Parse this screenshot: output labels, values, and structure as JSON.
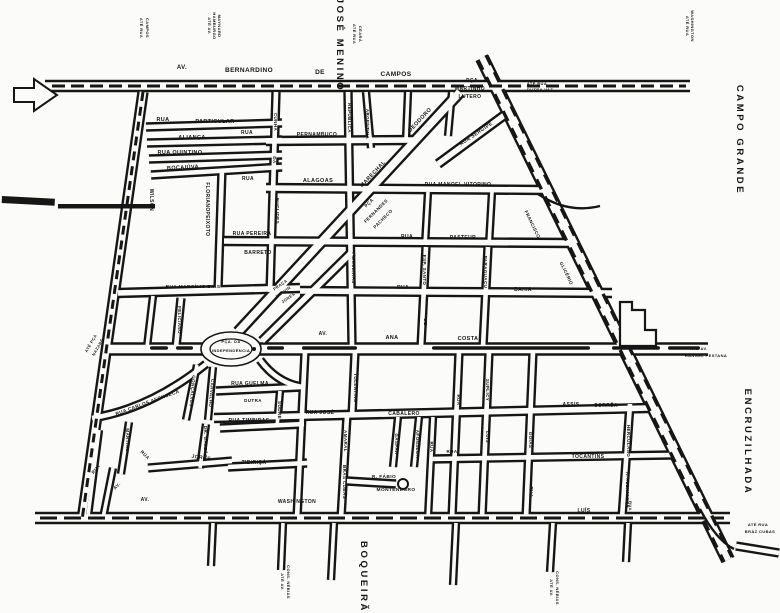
{
  "canvas": {
    "width": 780,
    "height": 613,
    "bg": "#fbfbf9",
    "ink": "#161616"
  },
  "districts": [
    {
      "text": "JOSÉ MENINO",
      "x": 337,
      "y": 45,
      "r": 90,
      "s": 9.5
    },
    {
      "text": "CAMPO GRANDE",
      "x": 737,
      "y": 140,
      "r": 90,
      "s": 9.5
    },
    {
      "text": "ENCRUZILHADA",
      "x": 745,
      "y": 442,
      "r": 90,
      "s": 9.5
    },
    {
      "text": "BOQUEIRÃO",
      "x": 361,
      "y": 582,
      "r": 90,
      "s": 9.5
    }
  ],
  "streets": [
    {
      "d": "M482,58 L728,560",
      "w": 12
    },
    {
      "d": "M45,86 L690,86",
      "w": 10
    },
    {
      "d": "M106,349 L708,349",
      "w": 11
    },
    {
      "d": "M35,518 L730,518",
      "w": 10
    },
    {
      "d": "M143,92 L82,520",
      "w": 9
    },
    {
      "d": "M238,332 L460,92",
      "w": 10
    },
    {
      "d": "M262,341 L352,252",
      "w": 8
    },
    {
      "d": "M438,164 L510,111",
      "w": 8
    },
    {
      "d": "M146,127 L282,123",
      "w": 7
    },
    {
      "d": "M147,143 L282,140",
      "w": 7
    },
    {
      "d": "M149,159 L282,155",
      "w": 7
    },
    {
      "d": "M151,175 L282,167",
      "w": 7
    },
    {
      "d": "M118,293 L300,288",
      "w": 8
    },
    {
      "d": "M266,141 L414,140",
      "w": 8
    },
    {
      "d": "M266,188 L545,190",
      "w": 8
    },
    {
      "d": "M224,241 L572,243",
      "w": 8
    },
    {
      "d": "M300,291 L612,293",
      "w": 8
    },
    {
      "d": "M276,92 L270,292",
      "w": 7
    },
    {
      "d": "M222,170 L218,290",
      "w": 7
    },
    {
      "d": "M348,92 L352,345",
      "w": 7
    },
    {
      "d": "M366,92 L371,148",
      "w": 6
    },
    {
      "d": "M408,92 L406,140",
      "w": 6
    },
    {
      "d": "M452,92 L448,136",
      "w": 6
    },
    {
      "d": "M428,192 L425,245",
      "w": 6
    },
    {
      "d": "M492,192 L489,245",
      "w": 6
    },
    {
      "d": "M426,247 L421,347",
      "w": 7
    },
    {
      "d": "M488,247 L483,347",
      "w": 7
    },
    {
      "d": "M181,298 L176,347",
      "w": 7
    },
    {
      "d": "M153,296 L147,347",
      "w": 6
    },
    {
      "d": "M92,418 Q150,409 206,364",
      "w": 7
    },
    {
      "d": "M197,365 L186,420",
      "w": 6
    },
    {
      "d": "M213,367 L208,420",
      "w": 6
    },
    {
      "d": "M148,468 L232,461",
      "w": 7
    },
    {
      "d": "M129,422 L121,474",
      "w": 6
    },
    {
      "d": "M206,424 L200,468",
      "w": 6
    },
    {
      "d": "M99,430 L88,516",
      "w": 6
    },
    {
      "d": "M113,468 L103,518",
      "w": 6
    },
    {
      "d": "M216,391 L302,387",
      "w": 7
    },
    {
      "d": "M260,360 Q277,383 302,387",
      "w": 7
    },
    {
      "d": "M220,428 L304,424",
      "w": 7
    },
    {
      "d": "M228,467 L307,463",
      "w": 7
    },
    {
      "d": "M280,391 L277,427",
      "w": 6
    },
    {
      "d": "M305,352 L297,518",
      "w": 7
    },
    {
      "d": "M355,352 L352,416",
      "w": 7
    },
    {
      "d": "M347,416 L341,518",
      "w": 7
    },
    {
      "d": "M214,418 L648,408",
      "w": 8
    },
    {
      "d": "M347,481 L396,484",
      "w": 7
    },
    {
      "d": "M398,417 L393,467",
      "w": 6
    },
    {
      "d": "M419,417 L414,467",
      "w": 6
    },
    {
      "d": "M433,417 L428,518",
      "w": 6
    },
    {
      "d": "M459,352 L452,518",
      "w": 7
    },
    {
      "d": "M489,352 L482,518",
      "w": 7
    },
    {
      "d": "M533,352 L526,518",
      "w": 7
    },
    {
      "d": "M430,459 L672,455",
      "w": 7
    },
    {
      "d": "M630,404 L622,518",
      "w": 7
    },
    {
      "d": "M213,523 L211,566",
      "w": 6
    },
    {
      "d": "M283,523 L281,570",
      "w": 6
    },
    {
      "d": "M334,523 L331,580",
      "w": 6
    },
    {
      "d": "M456,523 L453,585",
      "w": 6
    },
    {
      "d": "M553,523 L550,572",
      "w": 6
    },
    {
      "d": "M628,523 L626,562",
      "w": 6
    },
    {
      "d": "M736,546 L779,553",
      "w": 7
    }
  ],
  "overlays": [
    {
      "d": "M52,86 L686,86",
      "w": 3,
      "dash": "13 6"
    },
    {
      "d": "M40,518 L724,518",
      "w": 3,
      "dash": "17 7"
    },
    {
      "d": "M478,60 L724,562",
      "w": 3.4,
      "dash": "11 8"
    },
    {
      "d": "M486,55 L732,557",
      "w": 3.4,
      "dash": "11 8"
    },
    {
      "d": "M143,92 L82,520",
      "w": 3,
      "dash": "9 6"
    },
    {
      "d": "M538,194 Q568,214 600,206",
      "w": 2.4,
      "dash": ""
    },
    {
      "d": "M700,509 Q716,540 734,549",
      "w": 2.4,
      "dash": ""
    }
  ],
  "tram_pills_y": 346.3,
  "tram_pills": [
    [
      150,
      168
    ],
    [
      176,
      193
    ],
    [
      267,
      284
    ],
    [
      302,
      357
    ],
    [
      432,
      590
    ],
    [
      612,
      660
    ],
    [
      668,
      700
    ]
  ],
  "shapes": {
    "arrow_points": "14,88 34,88 34,79 57,95 34,111 34,102 14,102",
    "bars": [
      {
        "x": 2,
        "y": 196,
        "w": 53,
        "h": 7,
        "r": 3
      },
      {
        "x": 58,
        "y": 204,
        "w": 97,
        "h": 4.5,
        "r": 0
      }
    ],
    "building_d": "M620,302 L632,302 L632,310 L645,310 L645,330 L656,330 L656,346 L620,346 Z",
    "oval": {
      "cx": 231,
      "cy": 349,
      "rx": 30,
      "ry": 17
    },
    "oval_inner": {
      "cx": 231,
      "cy": 349,
      "rx": 21,
      "ry": 10
    },
    "dot": {
      "cx": 254,
      "cy": 349,
      "r": 2
    },
    "lollipop": {
      "cx": 403,
      "cy": 484,
      "r": 5
    }
  },
  "labels": [
    {
      "t": "AV.",
      "x": 182,
      "y": 69,
      "r": 0,
      "s": 6
    },
    {
      "t": "BERNARDINO",
      "x": 249,
      "y": 72,
      "r": 0,
      "s": 6.5
    },
    {
      "t": "DE",
      "x": 320,
      "y": 74,
      "r": 0,
      "s": 6.5
    },
    {
      "t": "CAMPOS",
      "x": 396,
      "y": 76,
      "r": 0,
      "s": 6.5
    },
    {
      "t": "PÇA",
      "x": 472,
      "y": 82,
      "r": 0,
      "s": 5
    },
    {
      "t": "MARTINHO",
      "x": 470,
      "y": 90,
      "r": 0,
      "s": 5
    },
    {
      "t": "LUTERO",
      "x": 470,
      "y": 98,
      "r": 0,
      "s": 5
    },
    {
      "t": "ATÉ RUA",
      "x": 537,
      "y": 85,
      "r": 0,
      "s": 4
    },
    {
      "t": "DUTRA VAZ",
      "x": 540,
      "y": 91,
      "r": 0,
      "s": 4
    },
    {
      "t": "ATÉ RUA",
      "x": 140,
      "y": 28,
      "r": 90,
      "s": 4
    },
    {
      "t": "CAMPOS",
      "x": 146,
      "y": 28,
      "r": 90,
      "s": 4
    },
    {
      "t": "ATÉ AV.",
      "x": 208,
      "y": 26,
      "r": 90,
      "s": 4
    },
    {
      "t": "HAMBURGO",
      "x": 213,
      "y": 26,
      "r": 90,
      "s": 4
    },
    {
      "t": "MAYNARD",
      "x": 218,
      "y": 26,
      "r": 90,
      "s": 4
    },
    {
      "t": "ATÉ RUA",
      "x": 353,
      "y": 34,
      "r": 90,
      "s": 4
    },
    {
      "t": "CEARÁ",
      "x": 359,
      "y": 34,
      "r": 90,
      "s": 4
    },
    {
      "t": "ATÉ RUA",
      "x": 686,
      "y": 26,
      "r": 90,
      "s": 4
    },
    {
      "t": "WASHINGTON",
      "x": 691,
      "y": 26,
      "r": 90,
      "s": 4
    },
    {
      "t": "RUA",
      "x": 163,
      "y": 121,
      "r": 0,
      "s": 5.5
    },
    {
      "t": "PARTICULAR",
      "x": 215,
      "y": 123,
      "r": 0,
      "s": 5.5
    },
    {
      "t": "ALIANÇA",
      "x": 192,
      "y": 139,
      "r": 0,
      "s": 5.5
    },
    {
      "t": "RUA QUINTINO",
      "x": 180,
      "y": 154,
      "r": 0,
      "s": 5.5
    },
    {
      "t": "BOCAIÚVA",
      "x": 183,
      "y": 169,
      "r": -3,
      "s": 5.5
    },
    {
      "t": "WILSON",
      "x": 150,
      "y": 200,
      "r": 90,
      "s": 5
    },
    {
      "t": "FLORIANO",
      "x": 206,
      "y": 197,
      "r": 90,
      "s": 5
    },
    {
      "t": "PEIXOTO",
      "x": 206,
      "y": 224,
      "r": 90,
      "s": 5
    },
    {
      "t": "RUA",
      "x": 247,
      "y": 134,
      "r": 0,
      "s": 5
    },
    {
      "t": "PERNAMBUCO",
      "x": 317,
      "y": 136,
      "r": 0,
      "s": 5
    },
    {
      "t": "CUNHA",
      "x": 274,
      "y": 122,
      "r": 90,
      "s": 4.5
    },
    {
      "t": "DA",
      "x": 273,
      "y": 160,
      "r": 90,
      "s": 4.5
    },
    {
      "t": "EUCLIDES",
      "x": 276,
      "y": 211,
      "r": 90,
      "s": 4.5
    },
    {
      "t": "RUA",
      "x": 248,
      "y": 180,
      "r": 0,
      "s": 5
    },
    {
      "t": "ALAGOAS",
      "x": 318,
      "y": 182,
      "r": 0,
      "s": 5.5
    },
    {
      "t": "REPÚBLICA",
      "x": 348,
      "y": 118,
      "r": 90,
      "s": 4.5
    },
    {
      "t": "ARGENTINA",
      "x": 366,
      "y": 124,
      "r": 90,
      "s": 4.5
    },
    {
      "t": "RUA PEREIRA",
      "x": 252,
      "y": 235,
      "r": 0,
      "s": 5
    },
    {
      "t": "BARRETO",
      "x": 258,
      "y": 254,
      "r": 0,
      "s": 5
    },
    {
      "t": "DEODORO",
      "x": 421,
      "y": 121,
      "r": -47,
      "s": 5.5
    },
    {
      "t": "MARECHAL",
      "x": 374,
      "y": 175,
      "r": -47,
      "s": 5.5
    },
    {
      "t": "RUA SERGIPE",
      "x": 477,
      "y": 135,
      "r": -34,
      "s": 5
    },
    {
      "t": "RUA MANOEL VITORINO",
      "x": 458,
      "y": 186,
      "r": 0,
      "s": 5
    },
    {
      "t": "PÇA",
      "x": 370,
      "y": 204,
      "r": -45,
      "s": 4.5
    },
    {
      "t": "FERNANDES",
      "x": 377,
      "y": 212,
      "r": -45,
      "s": 4.5
    },
    {
      "t": "PACHECO",
      "x": 384,
      "y": 220,
      "r": -45,
      "s": 4.5
    },
    {
      "t": "FILGUEIRAS",
      "x": 352,
      "y": 268,
      "r": 90,
      "s": 4.5
    },
    {
      "t": "RUA",
      "x": 407,
      "y": 238,
      "r": 0,
      "s": 5
    },
    {
      "t": "PASTEUR",
      "x": 463,
      "y": 239,
      "r": 0,
      "s": 5
    },
    {
      "t": "RUA",
      "x": 403,
      "y": 289,
      "r": 0,
      "s": 5
    },
    {
      "t": "BAHIA",
      "x": 523,
      "y": 291,
      "r": 0,
      "s": 5
    },
    {
      "t": "ESP. SANTO",
      "x": 423,
      "y": 270,
      "r": 90,
      "s": 4.5
    },
    {
      "t": "PARAGUAÇU",
      "x": 484,
      "y": 272,
      "r": 90,
      "s": 4.5
    },
    {
      "t": "FRANCISCO",
      "x": 531,
      "y": 225,
      "r": 64,
      "s": 4.5
    },
    {
      "t": "GLICÉRIO",
      "x": 565,
      "y": 274,
      "r": 64,
      "s": 4.5
    },
    {
      "t": "PRAÇA",
      "x": 281,
      "y": 286,
      "r": -35,
      "s": 4
    },
    {
      "t": "MELVIN",
      "x": 284,
      "y": 293,
      "r": -35,
      "s": 4
    },
    {
      "t": "JONES",
      "x": 289,
      "y": 299,
      "r": -35,
      "s": 4
    },
    {
      "t": "RUA MARCÍLIO DIAS",
      "x": 193,
      "y": 288,
      "r": 0,
      "s": 4.8
    },
    {
      "t": "FELICIANO",
      "x": 178,
      "y": 320,
      "r": 90,
      "s": 4.5
    },
    {
      "t": "ATÉ PÇA",
      "x": 92,
      "y": 344,
      "r": -60,
      "s": 4
    },
    {
      "t": "NAZARÉ",
      "x": 99,
      "y": 348,
      "r": -60,
      "s": 4
    },
    {
      "t": "PÇA. DA",
      "x": 231,
      "y": 343,
      "r": 0,
      "s": 4
    },
    {
      "t": "INDEPENDÊNCIA",
      "x": 231,
      "y": 352,
      "r": 0,
      "s": 4
    },
    {
      "t": "AV.",
      "x": 323,
      "y": 335,
      "r": 0,
      "s": 5
    },
    {
      "t": "ANA",
      "x": 392,
      "y": 339,
      "r": 0,
      "s": 5.5
    },
    {
      "t": "COSTA",
      "x": 468,
      "y": 340,
      "r": 0,
      "s": 5.5
    },
    {
      "t": "DE",
      "x": 424,
      "y": 322,
      "r": 90,
      "s": 4.5
    },
    {
      "t": "ATÉ AV.",
      "x": 699,
      "y": 350,
      "r": 0,
      "s": 4
    },
    {
      "t": "RANGEL PESTANA",
      "x": 706,
      "y": 357,
      "r": 0,
      "s": 4
    },
    {
      "t": "GONÇALVES",
      "x": 191,
      "y": 391,
      "r": 95,
      "s": 4.5
    },
    {
      "t": "CARVALHO",
      "x": 210,
      "y": 393,
      "r": 95,
      "s": 4.5
    },
    {
      "t": "RUA CARLOS AFONSECA",
      "x": 148,
      "y": 404,
      "r": -20,
      "s": 4.8
    },
    {
      "t": "MARTINS",
      "x": 126,
      "y": 440,
      "r": 90,
      "s": 4.5
    },
    {
      "t": "DR. GALEÃO",
      "x": 204,
      "y": 442,
      "r": 90,
      "s": 4.5
    },
    {
      "t": "RUA",
      "x": 144,
      "y": 456,
      "r": 45,
      "s": 4.5
    },
    {
      "t": "JORGE",
      "x": 201,
      "y": 459,
      "r": 8,
      "s": 5
    },
    {
      "t": "RUA",
      "x": 97,
      "y": 470,
      "r": -50,
      "s": 4.5
    },
    {
      "t": "AV.",
      "x": 118,
      "y": 487,
      "r": -45,
      "s": 4.5
    },
    {
      "t": "RUA GUELMA",
      "x": 250,
      "y": 385,
      "r": 0,
      "s": 5
    },
    {
      "t": "DUTRA",
      "x": 253,
      "y": 402,
      "r": 0,
      "s": 4.5
    },
    {
      "t": "SODRÉ",
      "x": 278,
      "y": 410,
      "r": 90,
      "s": 4.5
    },
    {
      "t": "RUA TIMBIRAS",
      "x": 249,
      "y": 422,
      "r": 0,
      "s": 5
    },
    {
      "t": "TIBIRIÇÁ",
      "x": 254,
      "y": 464,
      "r": 0,
      "s": 5
    },
    {
      "t": "TOLENTINO",
      "x": 354,
      "y": 388,
      "r": 90,
      "s": 4.5
    },
    {
      "t": "AMARAL",
      "x": 344,
      "y": 441,
      "r": 90,
      "s": 4.5
    },
    {
      "t": "BRÁS CUBAS",
      "x": 343,
      "y": 482,
      "r": 90,
      "s": 4.5
    },
    {
      "t": "RUA JOSÉ",
      "x": 320,
      "y": 414,
      "r": 0,
      "s": 5
    },
    {
      "t": "CABALERO",
      "x": 404,
      "y": 415,
      "r": 0,
      "s": 5
    },
    {
      "t": "GASPAR",
      "x": 395,
      "y": 444,
      "r": 90,
      "s": 4.5
    },
    {
      "t": "AFONSECA",
      "x": 416,
      "y": 444,
      "r": 90,
      "s": 4.5
    },
    {
      "t": "RUA",
      "x": 430,
      "y": 447,
      "r": 90,
      "s": 4.5
    },
    {
      "t": "RUA",
      "x": 457,
      "y": 400,
      "r": 90,
      "s": 4.5
    },
    {
      "t": "SUPLICY",
      "x": 486,
      "y": 390,
      "r": 90,
      "s": 4.5
    },
    {
      "t": "LUÍS",
      "x": 486,
      "y": 437,
      "r": 90,
      "s": 4.5
    },
    {
      "t": "RUA",
      "x": 452,
      "y": 453,
      "r": 0,
      "s": 4.5
    },
    {
      "t": "R. FÁBIO",
      "x": 384,
      "y": 478,
      "r": 0,
      "s": 4.8
    },
    {
      "t": "MONTENEGRO",
      "x": 396,
      "y": 491,
      "r": 0,
      "s": 4.8
    },
    {
      "t": "GOIÁS",
      "x": 529,
      "y": 440,
      "r": 90,
      "s": 4.5
    },
    {
      "t": "RUA",
      "x": 530,
      "y": 492,
      "r": 90,
      "s": 4.5
    },
    {
      "t": "ASSIS",
      "x": 571,
      "y": 406,
      "r": 0,
      "s": 5
    },
    {
      "t": "CORRÊA",
      "x": 606,
      "y": 407,
      "r": 0,
      "s": 5
    },
    {
      "t": "TOCANTINS",
      "x": 588,
      "y": 458,
      "r": 0,
      "s": 5
    },
    {
      "t": "HERCULANO",
      "x": 627,
      "y": 441,
      "r": 90,
      "s": 4.5
    },
    {
      "t": "R. ALEXANDRE",
      "x": 626,
      "y": 490,
      "r": 90,
      "s": 4.2
    },
    {
      "t": "AV.",
      "x": 145,
      "y": 501,
      "r": 0,
      "s": 5
    },
    {
      "t": "WASHINGTON",
      "x": 297,
      "y": 503,
      "r": 0,
      "s": 5
    },
    {
      "t": "LUÍS",
      "x": 584,
      "y": 512,
      "r": 0,
      "s": 5
    },
    {
      "t": "RUA",
      "x": 629,
      "y": 506,
      "r": 90,
      "s": 4
    },
    {
      "t": "ATÉ AV.",
      "x": 281,
      "y": 582,
      "r": 90,
      "s": 4
    },
    {
      "t": "CONS. NÉBIAS",
      "x": 287,
      "y": 582,
      "r": 90,
      "s": 4
    },
    {
      "t": "ATÉ AV.",
      "x": 550,
      "y": 588,
      "r": 90,
      "s": 4
    },
    {
      "t": "CONS. NÉBIAS",
      "x": 556,
      "y": 588,
      "r": 90,
      "s": 4
    },
    {
      "t": "ATÉ RUA",
      "x": 758,
      "y": 526,
      "r": 0,
      "s": 4
    },
    {
      "t": "BRÁZ CUBAS",
      "x": 760,
      "y": 533,
      "r": 0,
      "s": 4
    }
  ]
}
